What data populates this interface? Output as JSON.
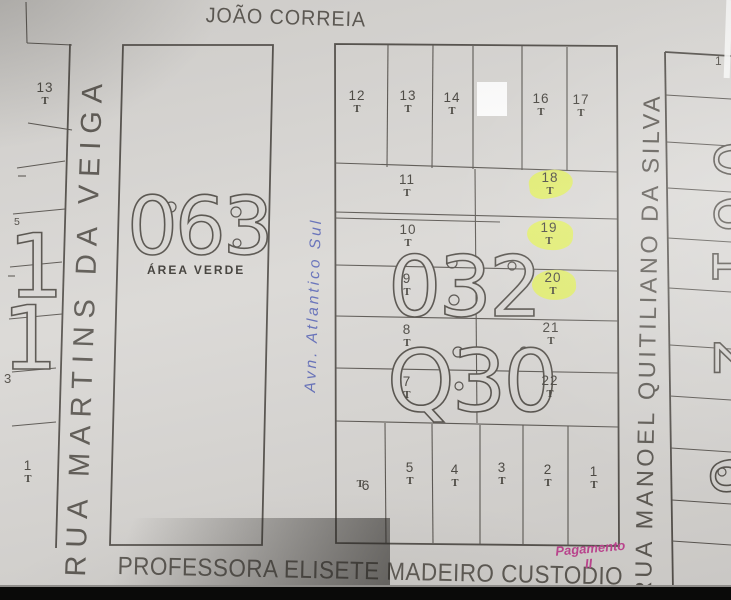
{
  "colors": {
    "paper": "#d8d6d3",
    "line": "#54504b",
    "highlight": "#e2f056",
    "ink_blue": "#5b67b5",
    "ink_pink": "#c23d90"
  },
  "streets": {
    "top": "JOÃO CORREIA",
    "left": "RUA MARTINS DA VEIGA",
    "right": "RUA MANOEL QUITILIANO DA SILVA",
    "bottom": "PROFESSORA ELISETE MADEIRO CUSTODIO",
    "avenue_handwritten": "Avn. Atlantico Sul"
  },
  "blocks": {
    "green_area": {
      "number": "063",
      "label": "ÁREA VERDE"
    },
    "middle_upper_number": "032",
    "middle_lower_number": "Q30",
    "left_big_digits": [
      "1",
      "1"
    ],
    "right_big_digits": [
      "0",
      "6",
      "1",
      "2",
      "6"
    ]
  },
  "lots": {
    "t_mark": "T",
    "top_row": [
      "12",
      "13",
      "14",
      "15",
      "16",
      "17"
    ],
    "middle_left": [
      "11",
      "10",
      "9",
      "8",
      "7"
    ],
    "middle_right": [
      "18",
      "19",
      "20",
      "21",
      "22"
    ],
    "highlighted": [
      "18",
      "19",
      "20"
    ],
    "bottom_row": [
      "6",
      "5",
      "4",
      "3",
      "2",
      "1"
    ],
    "left_strip": [
      "13",
      "5",
      "3",
      "1"
    ],
    "right_strip_corner": "1"
  },
  "annotations": {
    "pink_line1": "Pagamento",
    "pink_line2": "II"
  }
}
